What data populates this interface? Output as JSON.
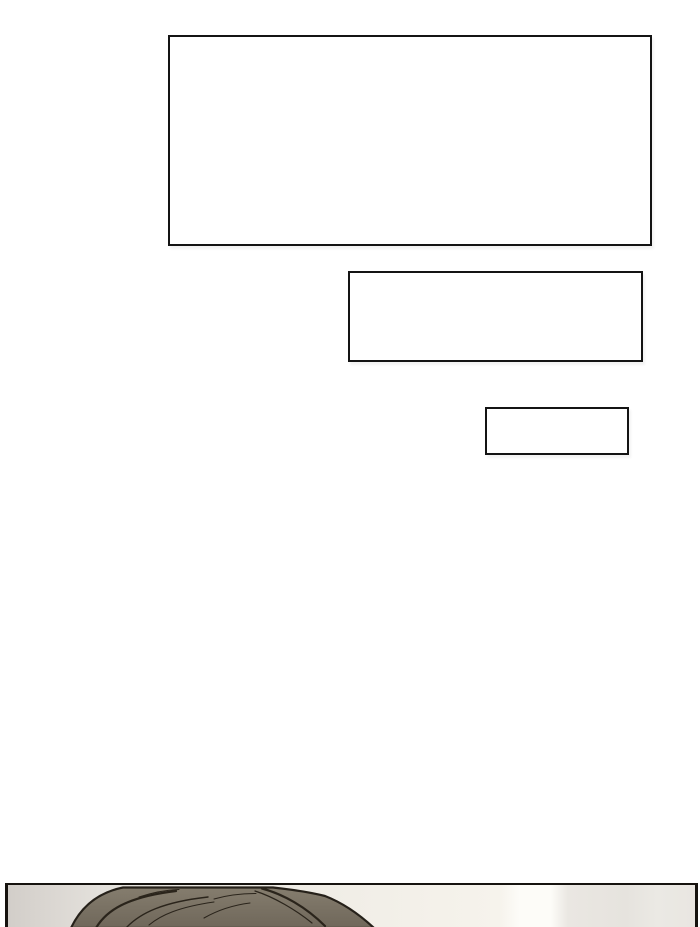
{
  "page": {
    "kind": "webtoon comic page segment",
    "background_color": "#ffffff"
  },
  "speech_boxes": [
    {
      "text": ""
    },
    {
      "text": ""
    },
    {
      "text": ""
    }
  ],
  "speech_box_style": {
    "border_color": "#141414",
    "fill_color": "#ffffff"
  },
  "panel": {
    "border_color": "#16130f",
    "wall_band_colors": [
      "#d2cec9",
      "#ebe8e2",
      "#fdfcf8",
      "#e6e3de",
      "#e9e6e1"
    ],
    "character": {
      "visible_part": "top of head",
      "hair_fill_color": "#7a7264",
      "hair_highlight_color": "#857d6e",
      "hair_outline_color": "#26211a"
    }
  }
}
